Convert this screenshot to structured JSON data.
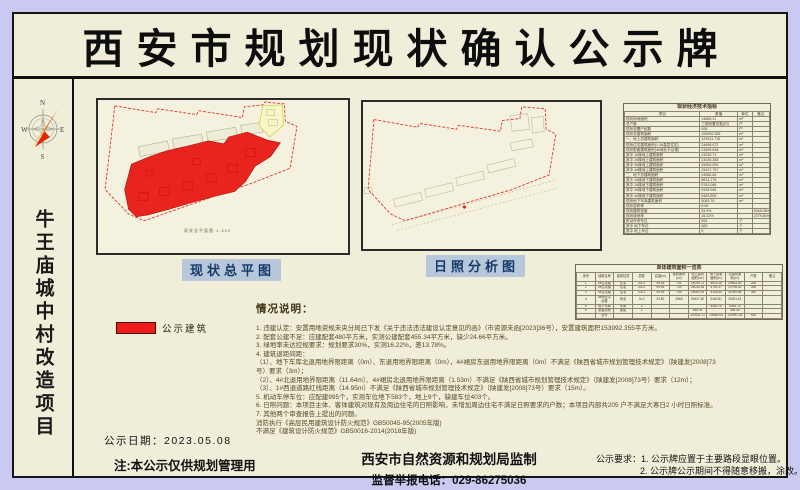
{
  "title": "西安市规划现状确认公示牌",
  "sidebar": {
    "project_name": "牛王庙城中村改造项目",
    "compass": {
      "n": "N",
      "e": "E",
      "s": "S",
      "w": "W"
    }
  },
  "plans": {
    "left_label": "现状总平图",
    "left_inner_caption": "现状总平面图 1:500",
    "right_label": "日照分析图"
  },
  "legend": {
    "label": "公示建筑",
    "swatch_color": "#ee1c1c"
  },
  "indicator_table": {
    "title": "现状经济技术指标",
    "headers": [
      "项目",
      "数值",
      "单位",
      "备注"
    ],
    "rows": [
      [
        "现状用地面积",
        "14665.11",
        "m²",
        ""
      ],
      [
        "总户数",
        "三期安置总数(约)",
        "户",
        ""
      ],
      [
        "现状安置产权数",
        "926",
        "户",
        ""
      ],
      [
        "现状总建筑面积",
        "153992.355",
        "m²",
        ""
      ],
      [
        "一、地上总建筑面积",
        "129311.715",
        "m²",
        ""
      ],
      [
        "现状住宅建筑面积(1-3#高层住宅)",
        "24698.672",
        "m²",
        ""
      ],
      [
        "现状配套建筑面积(4#商业平台楼)",
        "24599.838",
        "m²",
        ""
      ],
      [
        "其中 1#楼地上建筑面积",
        "24049.71",
        "m²",
        ""
      ],
      [
        "其中 2#楼地上建筑面积",
        "24035.358",
        "m²",
        ""
      ],
      [
        "其中 3#楼地上建筑面积",
        "25063.925",
        "m²",
        ""
      ],
      [
        "其中 4#楼地上建筑面积",
        "25437.797",
        "m²",
        ""
      ],
      [
        "二、地下总建筑面积",
        "24680.64",
        "m²",
        ""
      ],
      [
        "其中 1#楼地下建筑面积",
        "5614.176",
        "m²",
        ""
      ],
      [
        "其中 2#楼地下建筑面积",
        "5761.068",
        "m²",
        ""
      ],
      [
        "其中 3#楼地下建筑面积",
        "5335.948",
        "m²",
        ""
      ],
      [
        "其中 4#楼地下建筑面积",
        "5483.806",
        "m²",
        ""
      ],
      [
        "现状地下车库建筑面积",
        "5083.76",
        "m²",
        ""
      ],
      [
        "现状容积率",
        "8.59",
        "",
        ""
      ],
      [
        "现状建筑密度",
        "34.5%",
        "",
        "5048.06m²"
      ],
      [
        "现状绿地率",
        "16.22%",
        "",
        "2379.80m²"
      ],
      [
        "机动车停车位",
        "592",
        "个",
        ""
      ],
      [
        "其中 地下车位",
        "583",
        "个",
        ""
      ],
      [
        "其中 地上车位",
        "9",
        "个",
        ""
      ]
    ]
  },
  "area_table": {
    "title": "单体建筑面积一览表",
    "headers": [
      "序号",
      "建筑名称",
      "建筑性质",
      "层数",
      "高度(m)",
      "基底面积(m²)",
      "地上建筑面积(m²)",
      "地下建筑面积(m²)",
      "总建筑面积(m²)",
      "户数",
      "备注"
    ],
    "rows": [
      [
        "1",
        "1#住宅楼",
        "住宅",
        "33/-2",
        "99.45",
        "741",
        "24049.71",
        "5614.18",
        "29663.89",
        "288",
        ""
      ],
      [
        "2",
        "2#住宅楼",
        "住宅",
        "33/-2",
        "99.45",
        "739",
        "24035.36",
        "5761.07",
        "29796.43",
        "288",
        ""
      ],
      [
        "3",
        "3#住宅楼",
        "住宅",
        "33/-2",
        "99.45",
        "755",
        "25063.93",
        "5335.95",
        "30399.88",
        "350",
        ""
      ],
      [
        "4",
        "4#商业平台楼",
        "商业",
        "5/-2",
        "23.80",
        "2865",
        "25437.80",
        "5483.81",
        "30921.61",
        "",
        ""
      ],
      [
        "5",
        "地下车库",
        "车库",
        "-2",
        "",
        "",
        "",
        "5083.76",
        "5083.76",
        "",
        ""
      ],
      [
        "6",
        "配套用房",
        "配套",
        "1",
        "",
        "",
        "455.34",
        "",
        "455.34",
        "",
        ""
      ],
      [
        "",
        "合计",
        "",
        "",
        "",
        "",
        "129311.72",
        "24680.64",
        "153992.36",
        "926",
        ""
      ]
    ]
  },
  "situation": {
    "heading": "情况说明：",
    "lines": [
      "1. 违建认定：安置用地资规未央分局已下发《关于违法违法建设认定意见的函》（市资源未函[2023]36号），安置建筑面积153992.355平方米。",
      "2. 配套公建不足：应建配套480平方米，实测公建配套455.34平方米，缺少24.66平方米。",
      "3. 绿地率未达控规要求：规划要求30%，实测16.22%，差13.78%。",
      "4. 建筑退距间距：",
      "（1）、地下车库北退用地界限距离（0m）、东退用地界限距离（0m），4#裙房东退用地界限距离（0m）不满足《陕西省城市规划管理技术规定》（陕建发[2008]73",
      "号）要求（3m）；",
      "（2）、4#北退用地界限距离（11.64m）、4#裙房北退用地界限距离（1.53m）不满足《陕西省城市规划管理技术规定》（陕建发[2008]73号）要求（12m）；",
      "（3）、1#西退道路红线距离（14.95m）不满足《陕西省城市规划管理技术规定》（陕建发[2008]73号）要求（15m）。",
      "5. 机动车停车位：应配建995个，实测车位地下583个，地上9个，缺建车位403个。",
      "6. 日照问题：本项目主体、客体建筑对现有及周边住宅的日照影响，未增加周边住宅不满足日照要求的户数；本项目内部共205 户不满足大寒日2 小时日照标准。",
      "7. 其他两个审查报告上提出的问题。",
      "消防执行《高层民用建筑设计防火规范》GB50045-95(2005年版)",
      "不满足《建筑设计防火规范》GB50016-2014(2018年版)"
    ]
  },
  "footer": {
    "publish_date": "公示日期：2023.05.08",
    "note": "注:本公示仅供规划管理用",
    "authority": "西安市自然资源和规划局监制",
    "hotline": "监督举报电话：029-86275036",
    "requirements_line1": "公示要求：1. 公示牌应置于主要路段显眼位置。",
    "requirements_line2": "2. 公示牌公示期间不得随意移搬，涂改。"
  },
  "colors": {
    "background": "#c9c9f2",
    "board": "#f0edd9",
    "accent_red": "#ee1c1c",
    "boundary_red": "#e03428",
    "label_bg": "#b6c8da",
    "label_text": "#173a6a"
  }
}
